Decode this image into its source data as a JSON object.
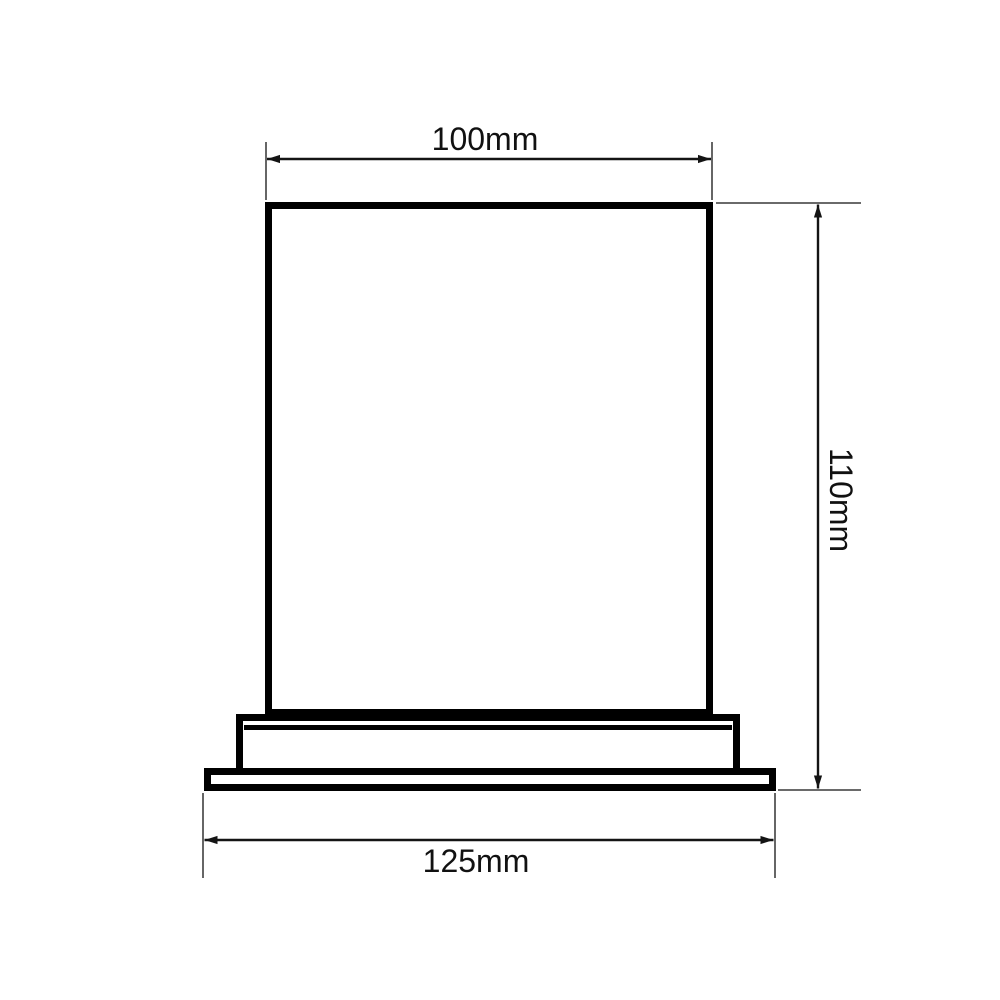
{
  "drawing": {
    "type": "technical-dimension-drawing",
    "unit": "mm",
    "dimensions": {
      "top_width": {
        "value": 100,
        "label": "100mm"
      },
      "right_height": {
        "value": 110,
        "label": "110mm"
      },
      "bottom_width": {
        "value": 125,
        "label": "125mm"
      }
    },
    "colors": {
      "line": "#000000",
      "extension_line": "#555555",
      "background": "#ffffff",
      "label_text": "#111111"
    }
  }
}
